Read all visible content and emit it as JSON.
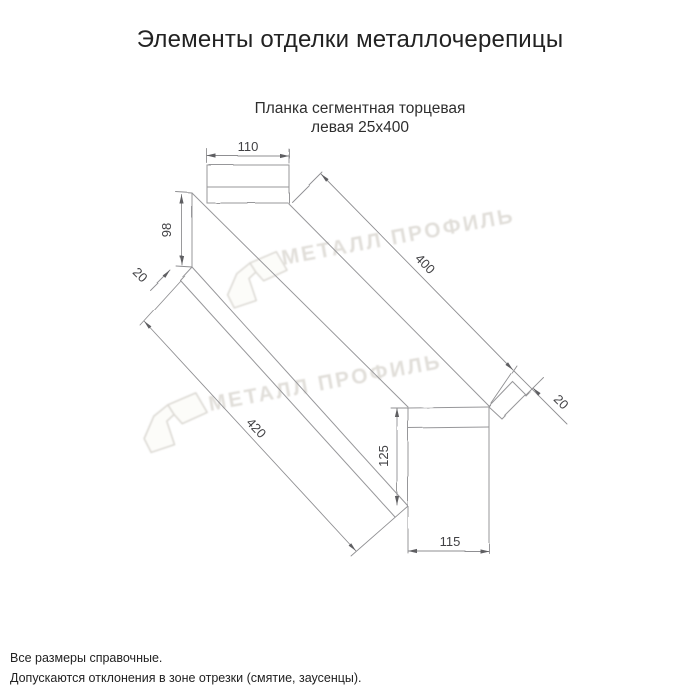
{
  "page": {
    "title": "Элементы отделки металлочерепицы"
  },
  "drawing": {
    "subtitle": {
      "line1": "Планка сегментная торцевая",
      "line2": "левая 25х400"
    },
    "dims": {
      "end_tab_width": "110",
      "left_face_height": "98",
      "left_hem": "20",
      "top_edge_length": "400",
      "right_hem": "20",
      "bottom_edge_length": "420",
      "right_face_height": "125",
      "right_end_width": "115"
    }
  },
  "watermark": {
    "brand": "МЕТАЛЛ ПРОФИЛЬ"
  },
  "footer": {
    "line1": "Все размеры справочные.",
    "line2": "Допускаются отклонения в зоне отрезки (смятие, заусенцы)."
  },
  "colors": {
    "line": "#97979a",
    "dim_text": "#414144",
    "watermark": "#cfcbc3",
    "text": "#222222"
  }
}
